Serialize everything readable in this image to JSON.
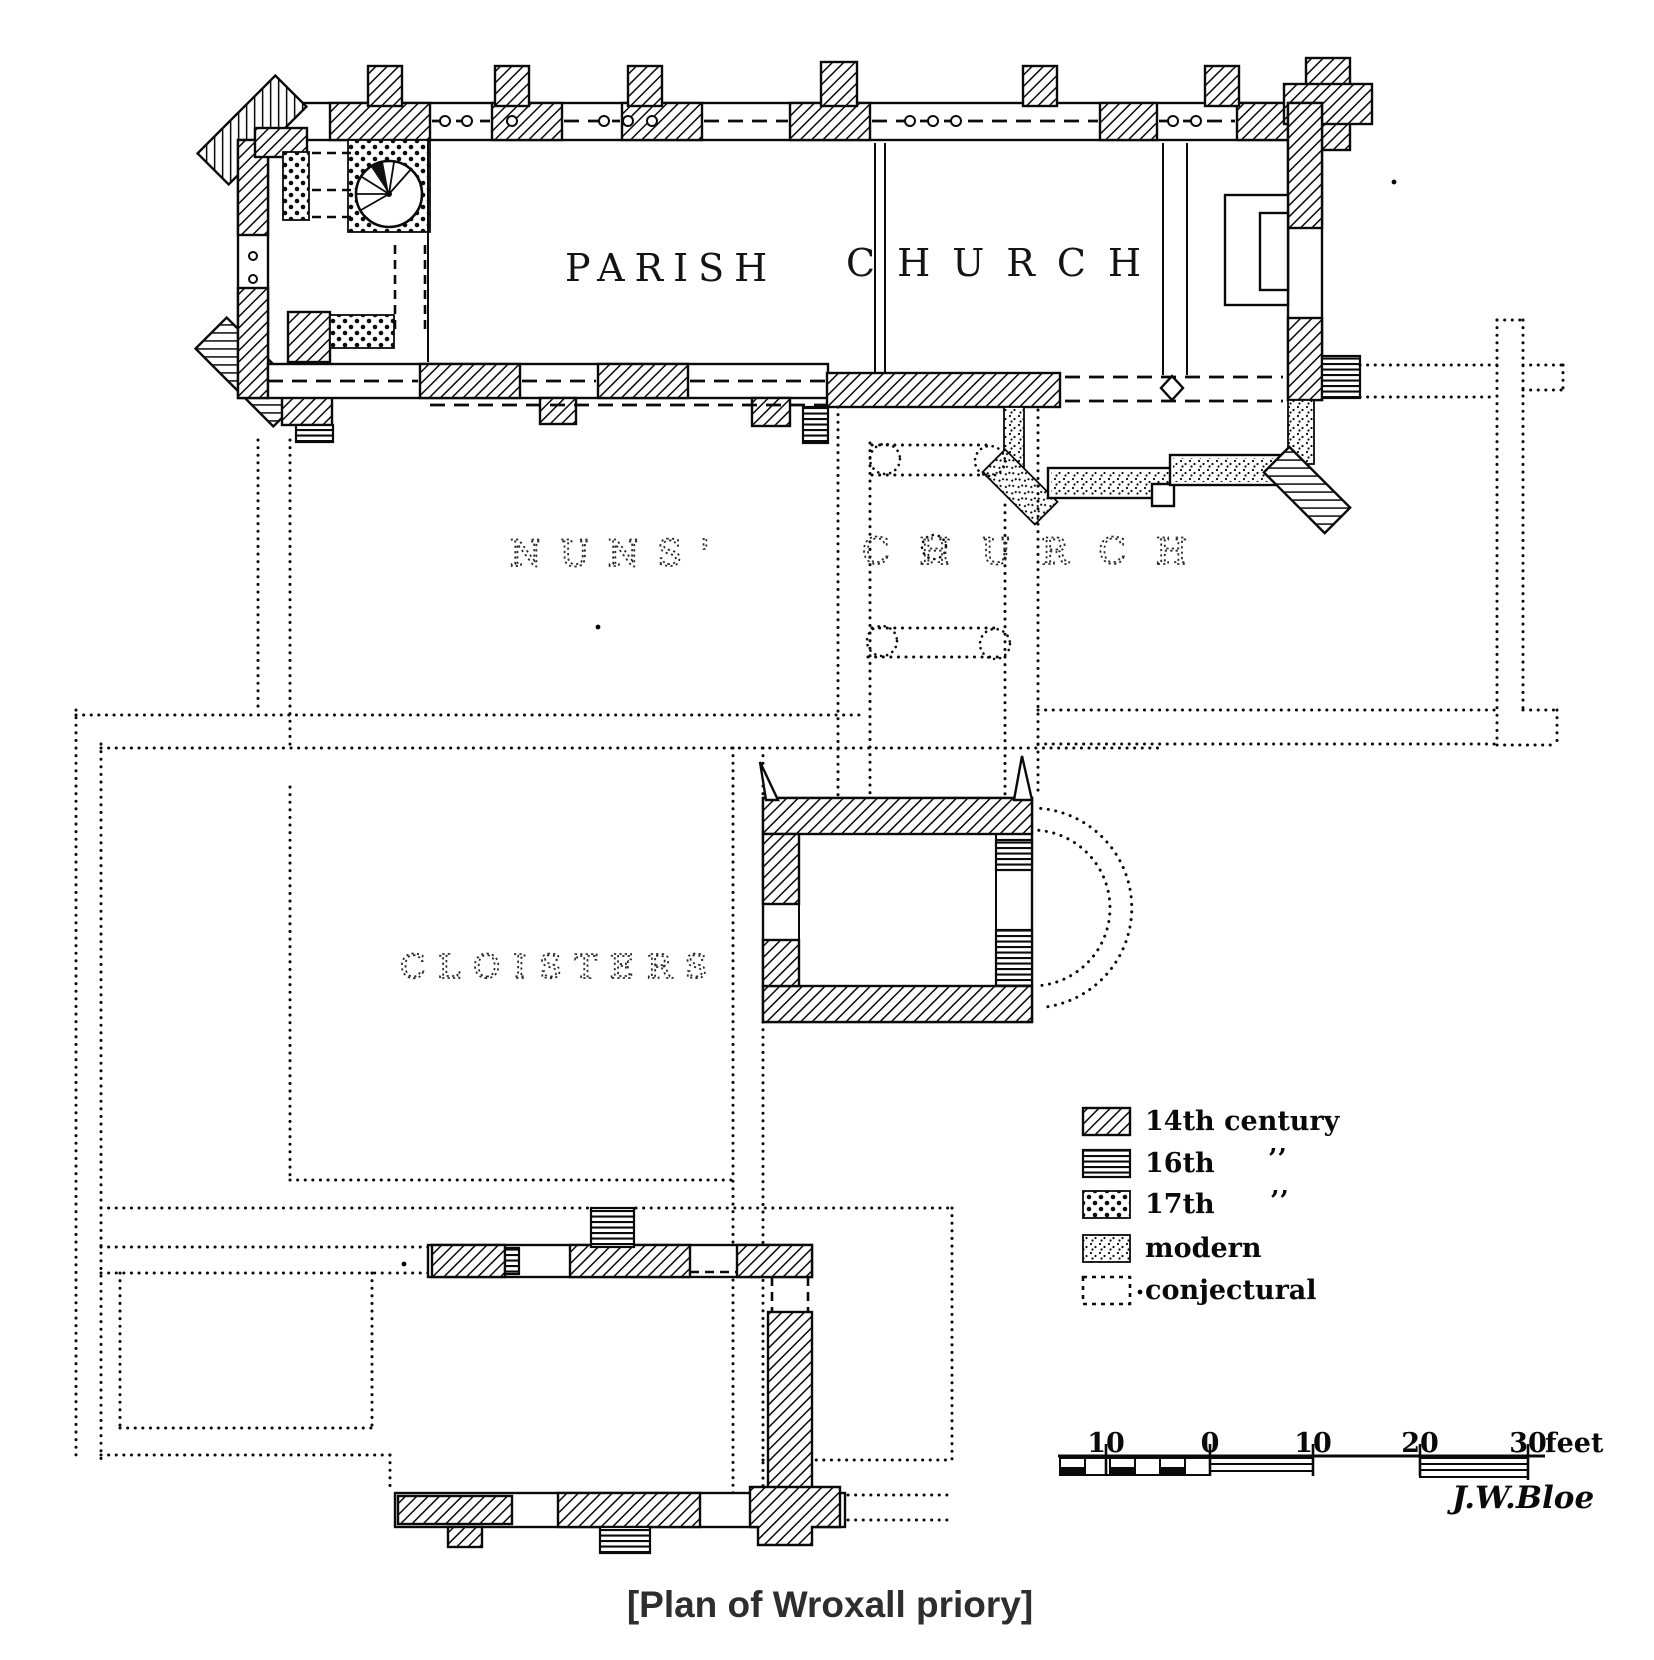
{
  "caption": "[Plan of Wroxall priory]",
  "plan_labels": {
    "parish_word1": "PARISH",
    "parish_word2": "CHURCH",
    "nuns_word1": "NUNS'",
    "nuns_word2": "CHURCH",
    "cloisters": "CLOISTERS"
  },
  "legend": {
    "items": [
      {
        "key": "14th-century",
        "label": "14th century",
        "ditto": ""
      },
      {
        "key": "16th-century",
        "label": "16th",
        "ditto": "’’"
      },
      {
        "key": "17th-century",
        "label": "17th",
        "ditto": "’’"
      },
      {
        "key": "modern",
        "label": "modern",
        "ditto": ""
      },
      {
        "key": "conjectural",
        "label": "conjectural",
        "ditto": ""
      }
    ]
  },
  "scale_bar": {
    "tick_labels": [
      "10",
      "0",
      "10",
      "20",
      "30"
    ],
    "unit": "feet"
  },
  "signature": "J.W.Bloe",
  "colors": {
    "ink": "#0a0a0a",
    "paper": "#ffffff",
    "caption": "#2e2e2e"
  }
}
